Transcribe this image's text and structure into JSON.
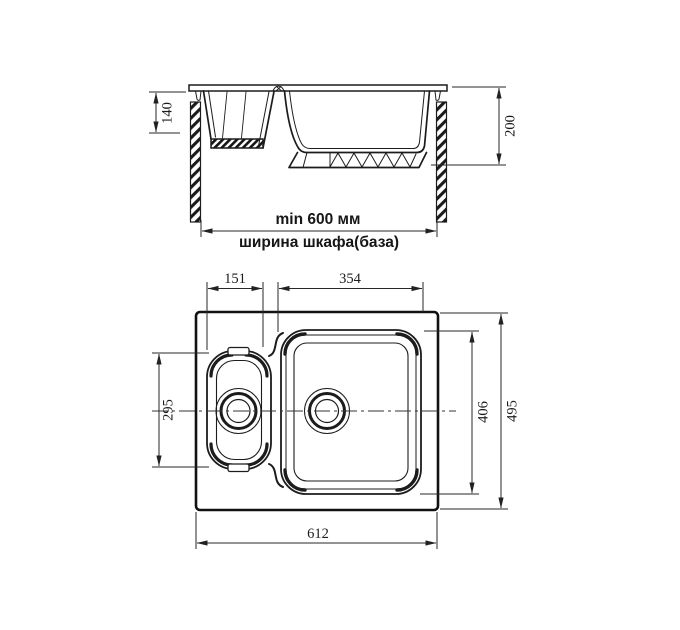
{
  "colors": {
    "line": "#1c1c1c",
    "background": "#ffffff"
  },
  "elevation": {
    "small_bowl_depth": "140",
    "overall_depth": "200",
    "min_cabinet_width": "min 600 мм",
    "cabinet_width_label": "ширина шкафа(база)"
  },
  "plan": {
    "small_bowl_width": "151",
    "large_bowl_width": "354",
    "small_bowl_length": "295",
    "large_bowl_length": "406",
    "overall_length": "495",
    "overall_width": "612"
  }
}
